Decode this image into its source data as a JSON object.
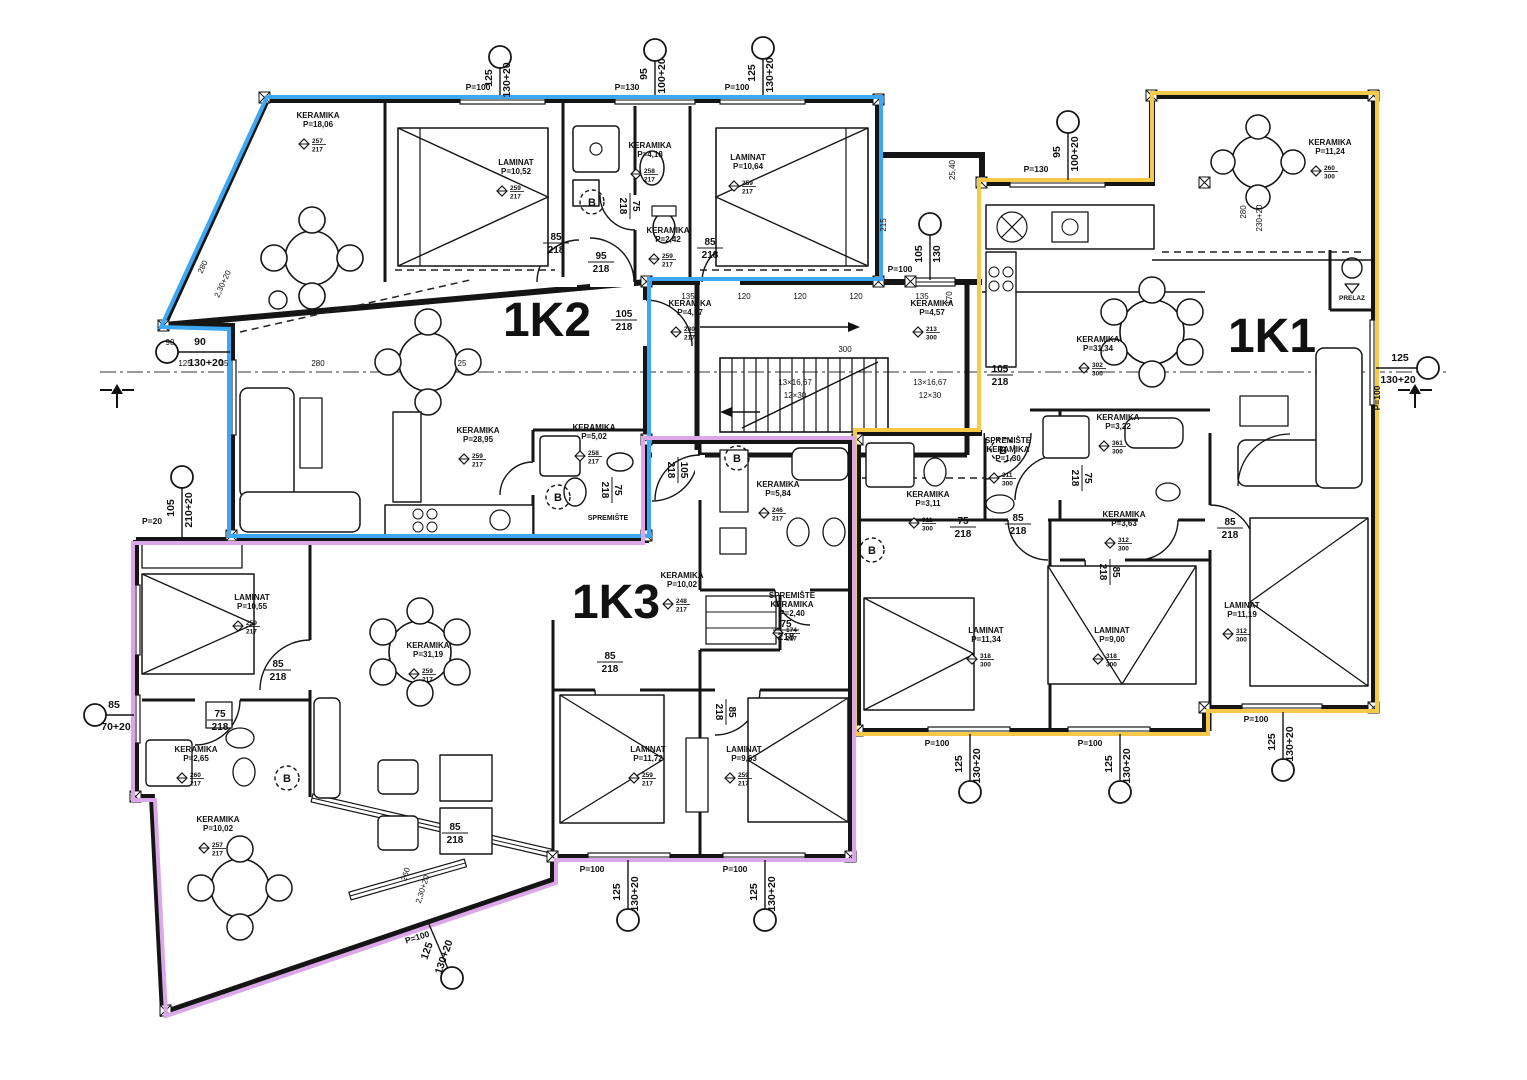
{
  "plan": {
    "colors": {
      "k1_yellow": "#F6C94A",
      "k2_blue": "#3BA7F5",
      "k3_purple": "#DCA7E8",
      "ink": "#151515"
    },
    "apartments": [
      {
        "id": "1K1",
        "color": "#F6C94A",
        "x": 1272,
        "y": 352
      },
      {
        "id": "1K2",
        "color": "#3BA7F5",
        "x": 547,
        "y": 336
      },
      {
        "id": "1K3",
        "color": "#DCA7E8",
        "x": 616,
        "y": 618
      }
    ],
    "rooms": [
      {
        "lines": [
          "KERAMIKA",
          "P=18,06"
        ],
        "x": 318,
        "y": 118,
        "m": [
          "257",
          "217"
        ]
      },
      {
        "lines": [
          "LAMINAT",
          "P=10,52"
        ],
        "x": 516,
        "y": 165,
        "m": [
          "259",
          "217"
        ]
      },
      {
        "lines": [
          "KERAMIKA",
          "P=4,18"
        ],
        "x": 650,
        "y": 148,
        "m": [
          "258",
          "217"
        ]
      },
      {
        "lines": [
          "KERAMIKA",
          "P=2,42"
        ],
        "x": 668,
        "y": 233,
        "m": [
          "259",
          "217"
        ]
      },
      {
        "lines": [
          "LAMINAT",
          "P=10,64"
        ],
        "x": 748,
        "y": 160,
        "m": [
          "259",
          "217"
        ]
      },
      {
        "lines": [
          "KERAMIKA",
          "P=11,24"
        ],
        "x": 1330,
        "y": 145,
        "m": [
          "260",
          "300"
        ]
      },
      {
        "lines": [
          "KERAMIKA",
          "P=31,34"
        ],
        "x": 1098,
        "y": 342,
        "m": [
          "302",
          "300"
        ]
      },
      {
        "lines": [
          "KERAMIKA",
          "P=28,95"
        ],
        "x": 478,
        "y": 433,
        "m": [
          "259",
          "217"
        ]
      },
      {
        "lines": [
          "KERAMIKA",
          "P=5,02"
        ],
        "x": 594,
        "y": 430,
        "m": [
          "258",
          "217"
        ]
      },
      {
        "lines": [
          "KERAMIKA",
          "P=4,57"
        ],
        "x": 690,
        "y": 306,
        "m": [
          "230",
          "217"
        ]
      },
      {
        "lines": [
          "KERAMIKA",
          "P=4,57"
        ],
        "x": 932,
        "y": 306,
        "m": [
          "213",
          "300"
        ]
      },
      {
        "lines": [
          "KERAMIKA",
          "P=10,02"
        ],
        "x": 682,
        "y": 578,
        "m": [
          "248",
          "217"
        ]
      },
      {
        "lines": [
          "KERAMIKA",
          "P=5,84"
        ],
        "x": 778,
        "y": 487,
        "m": [
          "246",
          "217"
        ]
      },
      {
        "lines": [
          "SPREMIŠTE",
          "KERAMIKA",
          "P=2,40"
        ],
        "x": 792,
        "y": 598,
        "m": [
          "174",
          "217"
        ]
      },
      {
        "lines": [
          "KERAMIKA",
          "P=31,19"
        ],
        "x": 428,
        "y": 648,
        "m": [
          "259",
          "217"
        ]
      },
      {
        "lines": [
          "LAMINAT",
          "P=10,55"
        ],
        "x": 252,
        "y": 600,
        "m": [
          "259",
          "217"
        ]
      },
      {
        "lines": [
          "KERAMIKA",
          "P=2,65"
        ],
        "x": 196,
        "y": 752,
        "m": [
          "260",
          "217"
        ]
      },
      {
        "lines": [
          "KERAMIKA",
          "P=10,02"
        ],
        "x": 218,
        "y": 822,
        "m": [
          "257",
          "217"
        ]
      },
      {
        "lines": [
          "LAMINAT",
          "P=11,72"
        ],
        "x": 648,
        "y": 752,
        "m": [
          "259",
          "217"
        ]
      },
      {
        "lines": [
          "LAMINAT",
          "P=9,63"
        ],
        "x": 744,
        "y": 752,
        "m": [
          "259",
          "217"
        ]
      },
      {
        "lines": [
          "KERAMIKA",
          "P=3,11"
        ],
        "x": 928,
        "y": 497,
        "m": [
          "311",
          "300"
        ]
      },
      {
        "lines": [
          "SPREMIŠTE",
          "KERAMIKA",
          "P=1,30"
        ],
        "x": 1008,
        "y": 443,
        "m": [
          "311",
          "300"
        ]
      },
      {
        "lines": [
          "KERAMIKA",
          "P=3,22"
        ],
        "x": 1118,
        "y": 420,
        "m": [
          "361",
          "300"
        ]
      },
      {
        "lines": [
          "KERAMIKA",
          "P=3,63"
        ],
        "x": 1124,
        "y": 517,
        "m": [
          "312",
          "300"
        ]
      },
      {
        "lines": [
          "LAMINAT",
          "P=11,34"
        ],
        "x": 986,
        "y": 633,
        "m": [
          "318",
          "300"
        ]
      },
      {
        "lines": [
          "LAMINAT",
          "P=9,00"
        ],
        "x": 1112,
        "y": 633,
        "m": [
          "318",
          "300"
        ]
      },
      {
        "lines": [
          "LAMINAT",
          "P=11,19"
        ],
        "x": 1242,
        "y": 608,
        "m": [
          "312",
          "300"
        ]
      }
    ],
    "doors": [
      {
        "t": "85/218",
        "x": 556,
        "y": 243,
        "rot": 0
      },
      {
        "t": "95/218",
        "x": 601,
        "y": 262,
        "rot": 0
      },
      {
        "t": "75/218",
        "x": 630,
        "y": 206,
        "rot": 90
      },
      {
        "t": "85/218",
        "x": 710,
        "y": 248,
        "rot": 0
      },
      {
        "t": "105/218",
        "x": 624,
        "y": 320,
        "rot": 0
      },
      {
        "t": "75/218",
        "x": 612,
        "y": 490,
        "rot": 90
      },
      {
        "t": "105/218",
        "x": 678,
        "y": 470,
        "rot": 90
      },
      {
        "t": "105/218",
        "x": 1000,
        "y": 375,
        "rot": 0
      },
      {
        "t": "75/218",
        "x": 1082,
        "y": 478,
        "rot": 90
      },
      {
        "t": "85/218",
        "x": 1018,
        "y": 524,
        "rot": 0
      },
      {
        "t": "75/218",
        "x": 963,
        "y": 527,
        "rot": 0
      },
      {
        "t": "85/218",
        "x": 1110,
        "y": 572,
        "rot": 90
      },
      {
        "t": "85/218",
        "x": 1230,
        "y": 528,
        "rot": 0
      },
      {
        "t": "85/218",
        "x": 278,
        "y": 670,
        "rot": 0
      },
      {
        "t": "75/218",
        "x": 220,
        "y": 720,
        "rot": 0
      },
      {
        "t": "85/218",
        "x": 455,
        "y": 833,
        "rot": 0
      },
      {
        "t": "85/218",
        "x": 610,
        "y": 662,
        "rot": 0
      },
      {
        "t": "85/218",
        "x": 726,
        "y": 712,
        "rot": 90
      },
      {
        "t": "75/218",
        "x": 786,
        "y": 630,
        "rot": 0
      }
    ],
    "markers": [
      {
        "cx": 500,
        "cy": 57,
        "x2": 500,
        "y2": 95,
        "t1": "125",
        "t1x": 492,
        "t1y": 78,
        "t2": "130+20",
        "t2x": 510,
        "t2y": 80,
        "rot": -90
      },
      {
        "cx": 655,
        "cy": 50,
        "x2": 655,
        "y2": 95,
        "t1": "95",
        "t1x": 647,
        "t1y": 74,
        "t2": "100+20",
        "t2x": 665,
        "t2y": 76,
        "rot": -90
      },
      {
        "cx": 763,
        "cy": 48,
        "x2": 763,
        "y2": 95,
        "t1": "125",
        "t1x": 755,
        "t1y": 73,
        "t2": "130+20",
        "t2x": 773,
        "t2y": 75,
        "rot": -90
      },
      {
        "cx": 1068,
        "cy": 122,
        "x2": 1068,
        "y2": 180,
        "t1": "95",
        "t1x": 1060,
        "t1y": 152,
        "t2": "100+20",
        "t2x": 1078,
        "t2y": 154,
        "rot": -90
      },
      {
        "cx": 930,
        "cy": 224,
        "x2": 930,
        "y2": 280,
        "t1": "105",
        "t1x": 922,
        "t1y": 254,
        "t2": "130",
        "t2x": 940,
        "t2y": 254,
        "rot": -90
      },
      {
        "cx": 167,
        "cy": 352,
        "x2": 230,
        "y2": 352,
        "t1": "90",
        "t1x": 200,
        "t1y": 345,
        "t2": "130+20",
        "t2x": 206,
        "t2y": 366,
        "rot": 0
      },
      {
        "cx": 182,
        "cy": 477,
        "x2": 182,
        "y2": 538,
        "t1": "105",
        "t1x": 174,
        "t1y": 508,
        "t2": "210+20",
        "t2x": 192,
        "t2y": 510,
        "rot": -90
      },
      {
        "cx": 95,
        "cy": 715,
        "x2": 134,
        "y2": 715,
        "t1": "85",
        "t1x": 114,
        "t1y": 708,
        "t2": "70+20",
        "t2x": 116,
        "t2y": 730,
        "rot": 0
      },
      {
        "cx": 628,
        "cy": 920,
        "x2": 628,
        "y2": 860,
        "t1": "125",
        "t1x": 620,
        "t1y": 892,
        "t2": "130+20",
        "t2x": 638,
        "t2y": 894,
        "rot": -90
      },
      {
        "cx": 765,
        "cy": 920,
        "x2": 765,
        "y2": 860,
        "t1": "125",
        "t1x": 757,
        "t1y": 892,
        "t2": "130+20",
        "t2x": 775,
        "t2y": 894,
        "rot": -90
      },
      {
        "cx": 970,
        "cy": 792,
        "x2": 970,
        "y2": 734,
        "t1": "125",
        "t1x": 962,
        "t1y": 764,
        "t2": "130+20",
        "t2x": 980,
        "t2y": 766,
        "rot": -90
      },
      {
        "cx": 1120,
        "cy": 792,
        "x2": 1120,
        "y2": 734,
        "t1": "125",
        "t1x": 1112,
        "t1y": 764,
        "t2": "130+20",
        "t2x": 1130,
        "t2y": 766,
        "rot": -90
      },
      {
        "cx": 1283,
        "cy": 770,
        "x2": 1283,
        "y2": 712,
        "t1": "125",
        "t1x": 1275,
        "t1y": 742,
        "t2": "130+20",
        "t2x": 1293,
        "t2y": 744,
        "rot": -90
      },
      {
        "cx": 1428,
        "cy": 368,
        "x2": 1376,
        "y2": 368,
        "t1": "125",
        "t1x": 1400,
        "t1y": 361,
        "t2": "130+20",
        "t2x": 1398,
        "t2y": 383,
        "rot": 0
      },
      {
        "cx": 452,
        "cy": 978,
        "x2": 428,
        "y2": 922,
        "t1": "125",
        "t1x": 430,
        "t1y": 952,
        "t2": "130+20",
        "t2x": 447,
        "t2y": 958,
        "rot": -71
      }
    ],
    "p_labels": [
      {
        "t": "P=100",
        "x": 478,
        "y": 90,
        "rot": 0
      },
      {
        "t": "P=130",
        "x": 627,
        "y": 90,
        "rot": 0
      },
      {
        "t": "P=100",
        "x": 737,
        "y": 90,
        "rot": 0
      },
      {
        "t": "P=130",
        "x": 1036,
        "y": 172,
        "rot": 0
      },
      {
        "t": "P=100",
        "x": 900,
        "y": 272,
        "rot": 0
      },
      {
        "t": "P=100",
        "x": 592,
        "y": 872,
        "rot": 0
      },
      {
        "t": "P=100",
        "x": 735,
        "y": 872,
        "rot": 0
      },
      {
        "t": "P=100",
        "x": 937,
        "y": 746,
        "rot": 0
      },
      {
        "t": "P=100",
        "x": 1090,
        "y": 746,
        "rot": 0
      },
      {
        "t": "P=100",
        "x": 1256,
        "y": 722,
        "rot": 0
      },
      {
        "t": "P=100",
        "x": 418,
        "y": 940,
        "rot": -17
      },
      {
        "t": "P=100",
        "x": 1380,
        "y": 398,
        "rot": -90
      },
      {
        "t": "P=20",
        "x": 152,
        "y": 524,
        "rot": 0
      }
    ],
    "small_dims": [
      {
        "t": "135",
        "x": 688,
        "y": 299,
        "rot": 0
      },
      {
        "t": "120",
        "x": 744,
        "y": 299,
        "rot": 0
      },
      {
        "t": "120",
        "x": 800,
        "y": 299,
        "rot": 0
      },
      {
        "t": "120",
        "x": 856,
        "y": 299,
        "rot": 0
      },
      {
        "t": "135",
        "x": 922,
        "y": 299,
        "rot": 0
      },
      {
        "t": "300",
        "x": 845,
        "y": 352,
        "rot": 0
      },
      {
        "t": "13×16,67",
        "x": 795,
        "y": 385,
        "rot": 0
      },
      {
        "t": "12×30",
        "x": 795,
        "y": 398,
        "rot": 0
      },
      {
        "t": "13×16,67",
        "x": 930,
        "y": 385,
        "rot": 0
      },
      {
        "t": "12×30",
        "x": 930,
        "y": 398,
        "rot": 0
      },
      {
        "t": "125",
        "x": 185,
        "y": 366,
        "rot": 0
      },
      {
        "t": "35",
        "x": 224,
        "y": 366,
        "rot": 0
      },
      {
        "t": "280",
        "x": 318,
        "y": 366,
        "rot": 0
      },
      {
        "t": "25",
        "x": 462,
        "y": 366,
        "rot": 0
      },
      {
        "t": "215",
        "x": 886,
        "y": 225,
        "rot": -90
      },
      {
        "t": "170",
        "x": 952,
        "y": 298,
        "rot": -90
      },
      {
        "t": "25,40",
        "x": 955,
        "y": 170,
        "rot": -90
      },
      {
        "t": "280",
        "x": 1246,
        "y": 212,
        "rot": -90
      },
      {
        "t": "230+20",
        "x": 1262,
        "y": 218,
        "rot": -90
      },
      {
        "t": "280",
        "x": 205,
        "y": 268,
        "rot": -65
      },
      {
        "t": "2,30+20",
        "x": 225,
        "y": 285,
        "rot": -65
      },
      {
        "t": "260",
        "x": 408,
        "y": 875,
        "rot": -72
      },
      {
        "t": "2,30+20",
        "x": 425,
        "y": 890,
        "rot": -72
      },
      {
        "t": "90",
        "x": 170,
        "y": 345,
        "rot": 0
      }
    ],
    "b_circles": [
      {
        "x": 592,
        "y": 202
      },
      {
        "x": 558,
        "y": 497
      },
      {
        "x": 737,
        "y": 458
      },
      {
        "x": 287,
        "y": 778
      },
      {
        "x": 872,
        "y": 550
      },
      {
        "x": 1003,
        "y": 450
      }
    ],
    "misc": [
      {
        "t": "SPREMIŠTE",
        "x": 608,
        "y": 520,
        "size": 7
      },
      {
        "t": "PRELAZ",
        "x": 1352,
        "y": 300,
        "size": 6.5
      }
    ],
    "stair_note": {
      "flights": "13×16,67 / 12×30"
    }
  }
}
